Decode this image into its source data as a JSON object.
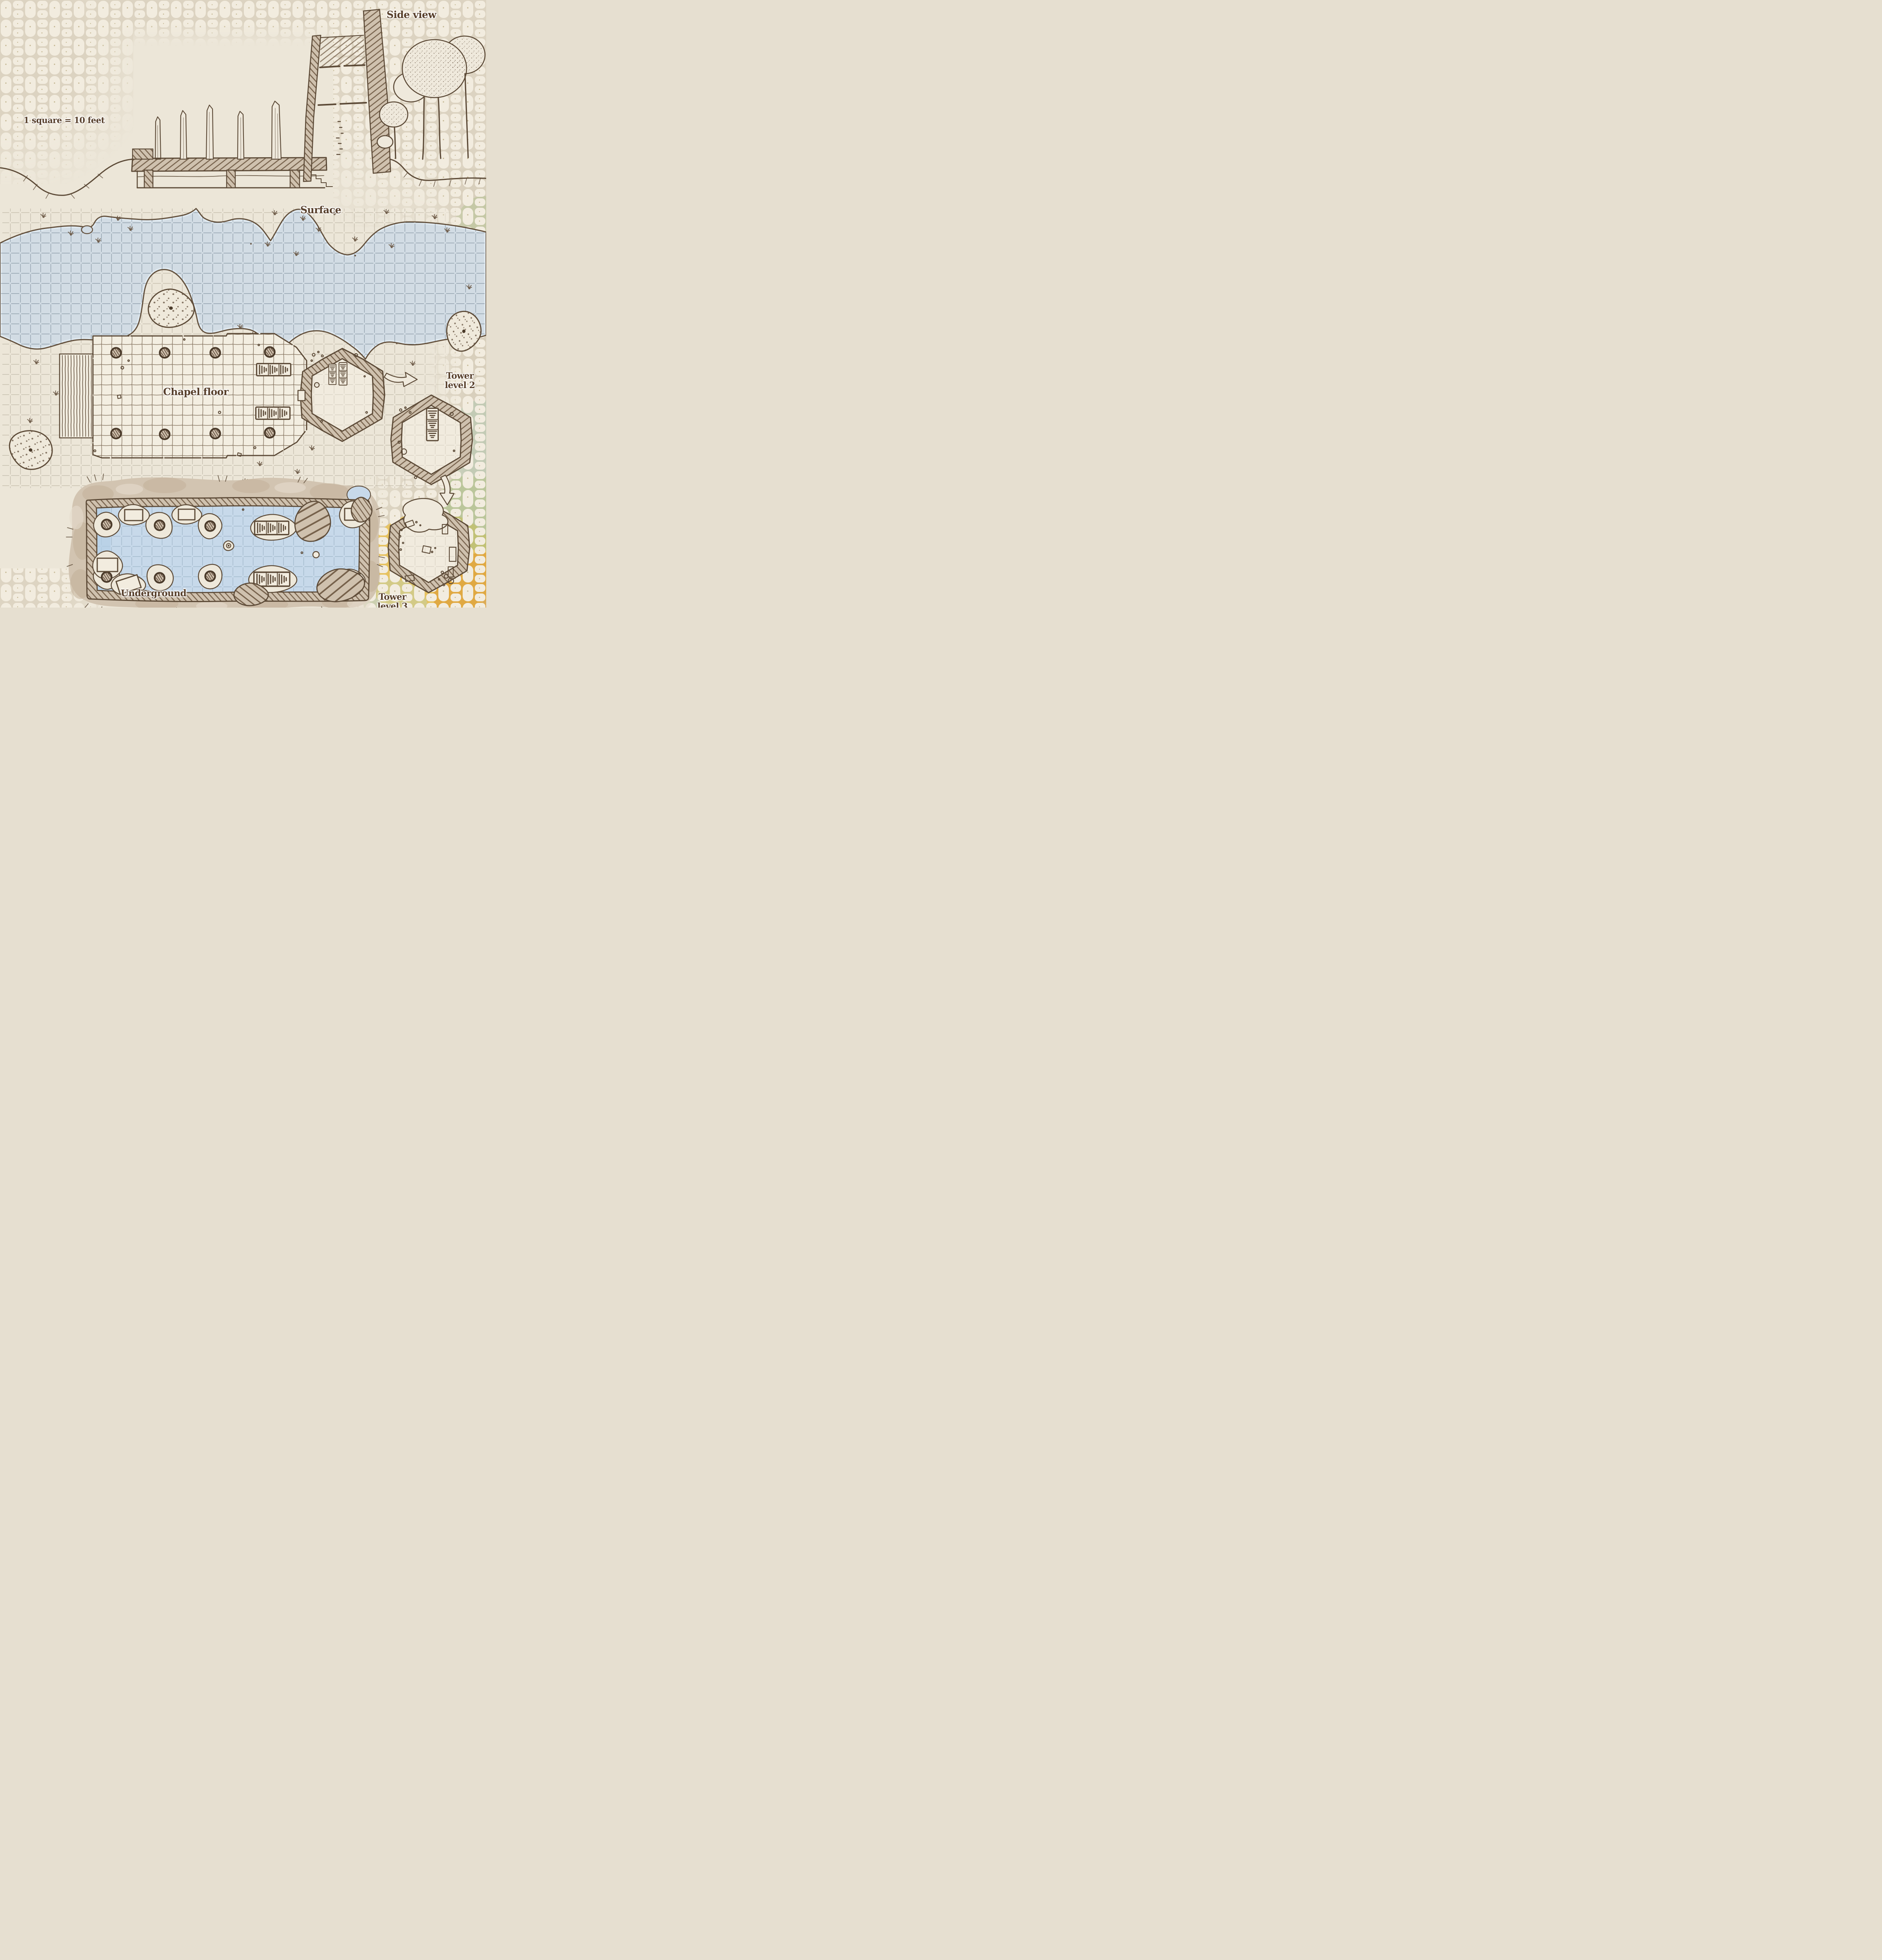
{
  "labels": {
    "side_view": "Side view",
    "surface": "Surface",
    "chapel_floor": "Chapel floor",
    "tower_level_2": "Tower level 2",
    "underground": "Underground",
    "tower_level_3": "Tower level 3"
  },
  "legend": {
    "scale_text": "1 square = 10 feet"
  },
  "icons": {
    "stairs": "striped-rectangle-stairs-icon",
    "pillar": "hatched-circle-pillar-icon",
    "rubble_mound": "stippled-blob-icon",
    "tree": "stippled-canopy-tree-icon",
    "flow_arrow": "outline-arrow-icon"
  },
  "colors": {
    "ink": "#5c4a37",
    "label_text": "#573f2b",
    "parchment": "#ece6d8",
    "cobble_stone": "#f2ecdf",
    "cobble_grout": "#dcd3c1",
    "lake_water": "#d2dce4",
    "underground_water": "#c7d9ea",
    "wall_fill": "#cfc1ae",
    "wall_hatch": "#76614b",
    "dirt": "#d2c4b1",
    "tint_yellow": "#e9c050",
    "tint_orange": "#dfa33c",
    "tint_green": "#a9bf85"
  }
}
